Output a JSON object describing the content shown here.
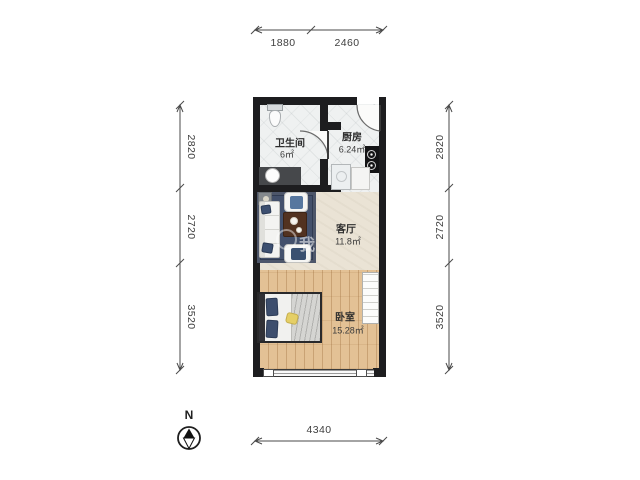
{
  "rooms": [
    {
      "name": "卫生间",
      "area": "6㎡"
    },
    {
      "name": "厨房",
      "area": "6.24㎡"
    },
    {
      "name": "客厅",
      "area": "11.8㎡"
    },
    {
      "name": "卧室",
      "area": "15.28㎡"
    }
  ],
  "dimensions": {
    "top": [
      "1880",
      "2460"
    ],
    "bottom": [
      "4340"
    ],
    "left": [
      "2820",
      "2720",
      "3520"
    ],
    "right": [
      "2820",
      "2720",
      "3520"
    ]
  },
  "compass": {
    "label": "N"
  },
  "watermark": {
    "text": "我"
  },
  "furniture_icons": [
    "toilet-icon",
    "sink-icon",
    "stove-icon",
    "washing-machine-icon",
    "counter-icon",
    "sofa-icon",
    "armchair-icon",
    "coffee-table-icon",
    "rug-icon",
    "side-table-icon",
    "bed-icon",
    "wardrobe-icon",
    "window-icon",
    "entry-door-icon",
    "bathroom-door-icon",
    "compass-icon"
  ],
  "colors": {
    "wall": "#1d1d1f",
    "tile_floor": "#eff1f1",
    "living_floor": "#eae3d5",
    "wood_floor": "#e3c195",
    "rug": "#43506b",
    "accent_navy": "#3d4e6d",
    "table_brown": "#523220",
    "dimension_text": "#3f3f3f"
  }
}
